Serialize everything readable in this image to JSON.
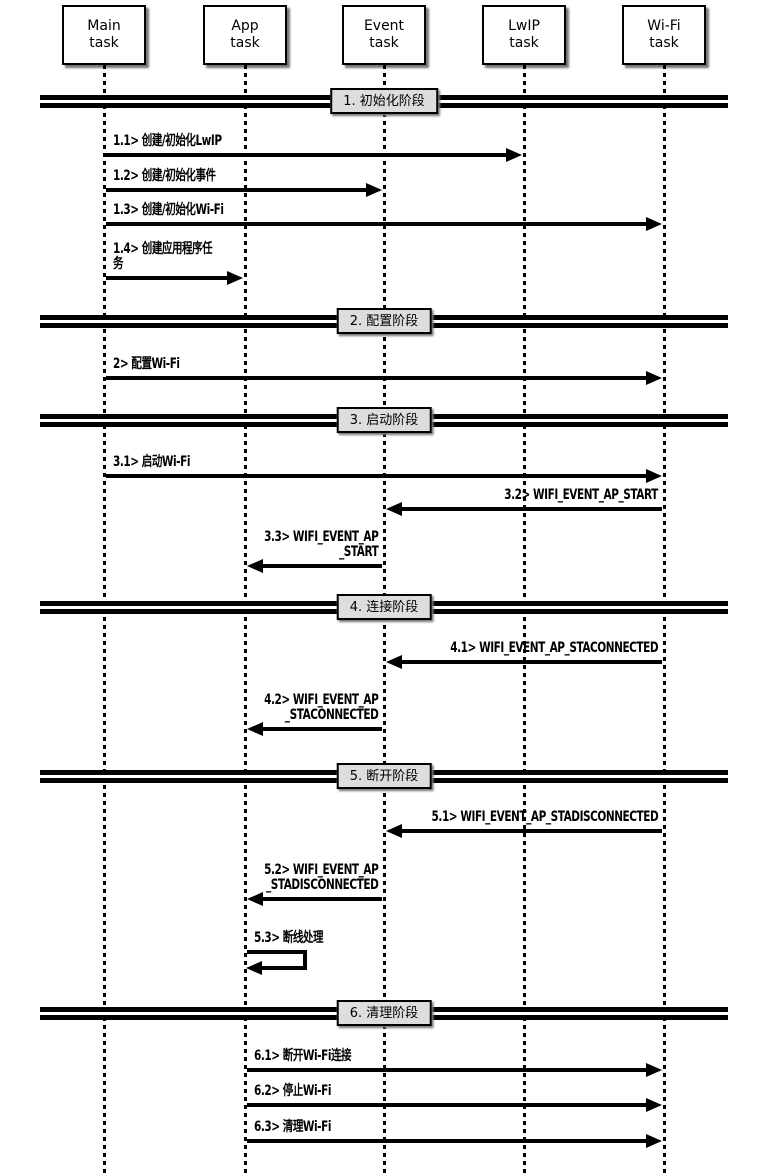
{
  "diagram": {
    "kind": "sequence-diagram",
    "actors": [
      {
        "id": "main",
        "label": "Main\ntask"
      },
      {
        "id": "app",
        "label": "App\ntask"
      },
      {
        "id": "event",
        "label": "Event\ntask"
      },
      {
        "id": "lwip",
        "label": "LwIP\ntask"
      },
      {
        "id": "wifi",
        "label": "Wi-Fi\ntask"
      }
    ],
    "phases": [
      {
        "id": "1",
        "label": "1. 初始化阶段"
      },
      {
        "id": "2",
        "label": "2. 配置阶段"
      },
      {
        "id": "3",
        "label": "3. 启动阶段"
      },
      {
        "id": "4",
        "label": "4. 连接阶段"
      },
      {
        "id": "5",
        "label": "5. 断开阶段"
      },
      {
        "id": "6",
        "label": "6. 清理阶段"
      }
    ],
    "messages": [
      {
        "id": "1.1",
        "label": "1.1> 创建/初始化LwIP",
        "from": "main",
        "to": "lwip"
      },
      {
        "id": "1.2",
        "label": "1.2> 创建/初始化事件",
        "from": "main",
        "to": "event"
      },
      {
        "id": "1.3",
        "label": "1.3> 创建/初始化Wi-Fi",
        "from": "main",
        "to": "wifi"
      },
      {
        "id": "1.4",
        "label": "1.4> 创建应用程序任\n务",
        "from": "main",
        "to": "app"
      },
      {
        "id": "2",
        "label": "2> 配置Wi-Fi",
        "from": "main",
        "to": "wifi"
      },
      {
        "id": "3.1",
        "label": "3.1> 启动Wi-Fi",
        "from": "main",
        "to": "wifi"
      },
      {
        "id": "3.2",
        "label": "3.2> WIFI_EVENT_AP_START",
        "from": "wifi",
        "to": "event"
      },
      {
        "id": "3.3",
        "label": "3.3> WIFI_EVENT_AP\n_START",
        "from": "event",
        "to": "app"
      },
      {
        "id": "4.1",
        "label": "4.1> WIFI_EVENT_AP_STACONNECTED",
        "from": "wifi",
        "to": "event"
      },
      {
        "id": "4.2",
        "label": "4.2> WIFI_EVENT_AP\n_STACONNECTED",
        "from": "event",
        "to": "app"
      },
      {
        "id": "5.1",
        "label": "5.1> WIFI_EVENT_AP_STADISCONNECTED",
        "from": "wifi",
        "to": "event"
      },
      {
        "id": "5.2",
        "label": "5.2> WIFI_EVENT_AP\n_STADISCONNECTED",
        "from": "event",
        "to": "app"
      },
      {
        "id": "5.3",
        "label": "5.3> 断线处理",
        "from": "app",
        "to": "app"
      },
      {
        "id": "6.1",
        "label": "6.1> 断开Wi-Fi连接",
        "from": "app",
        "to": "wifi"
      },
      {
        "id": "6.2",
        "label": "6.2> 停止Wi-Fi",
        "from": "app",
        "to": "wifi"
      },
      {
        "id": "6.3",
        "label": "6.3> 清理Wi-Fi",
        "from": "app",
        "to": "wifi"
      }
    ],
    "colors": {
      "line": "#000000",
      "phase_box_fill": "#dddddd",
      "background": "#ffffff"
    }
  }
}
